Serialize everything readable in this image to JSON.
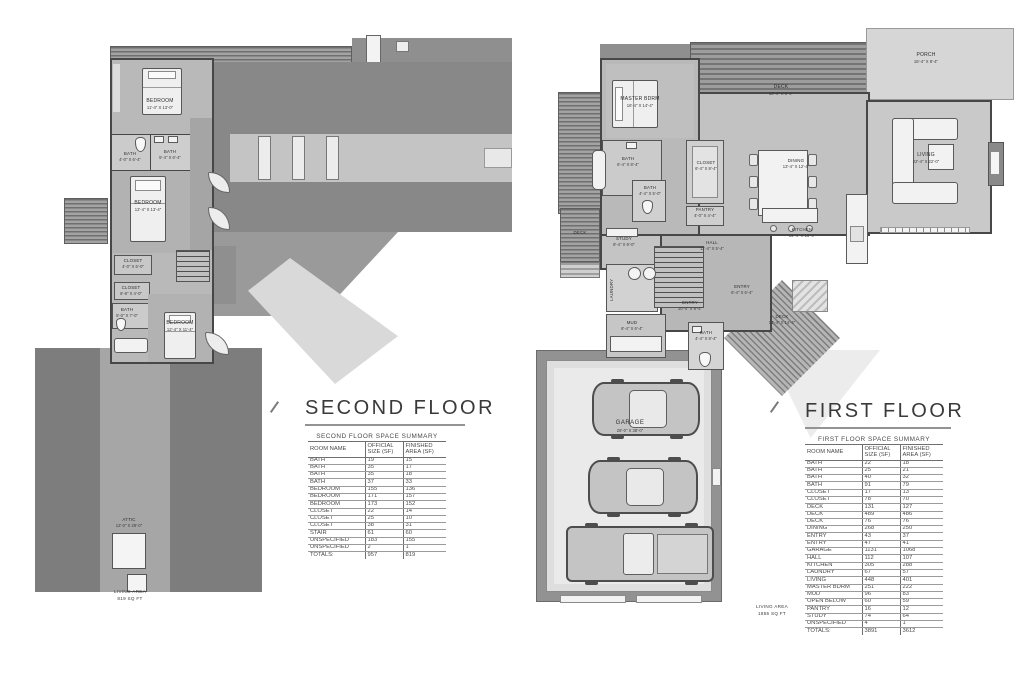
{
  "palette": {
    "paper": "#ffffff",
    "roof_dark": "#6f6f6f",
    "roof_mid": "#888888",
    "roof_light": "#c6c6c6",
    "building_fill": "#b9b9b9",
    "wall_line": "#474747",
    "fixture": "#f2f2f2",
    "table_line": "#9b9b9b",
    "text": "#3a3a3a"
  },
  "second_floor": {
    "title": "SECOND FLOOR",
    "summary": {
      "caption": "SECOND FLOOR SPACE SUMMARY",
      "columns": [
        "ROOM NAME",
        "OFFICIAL SIZE (SF)",
        "FINISHED AREA (SF)"
      ],
      "rows": [
        [
          "BATH",
          "19",
          "15"
        ],
        [
          "BATH",
          "35",
          "17"
        ],
        [
          "BATH",
          "35",
          "18"
        ],
        [
          "BATH",
          "37",
          "33"
        ],
        [
          "BEDROOM",
          "155",
          "136"
        ],
        [
          "BEDROOM",
          "171",
          "157"
        ],
        [
          "BEDROOM",
          "173",
          "152"
        ],
        [
          "CLOSET",
          "22",
          "14"
        ],
        [
          "CLOSET",
          "25",
          "10"
        ],
        [
          "CLOSET",
          "38",
          "31"
        ],
        [
          "STAIR",
          "61",
          "60"
        ],
        [
          "UNSPECIFIED",
          "183",
          "155"
        ],
        [
          "UNSPECIFIED",
          "2",
          "1"
        ]
      ],
      "totals": [
        "TOTALS:",
        "957",
        "819"
      ]
    },
    "rooms": {
      "bedroom1": {
        "name": "BEDROOM",
        "dims": "11'-4\" X 13'-0\""
      },
      "bath1": {
        "name": "BATH",
        "dims": "4'-0\" X 6'-4\""
      },
      "bath2": {
        "name": "BATH",
        "dims": "5'-4\" X 6'-4\""
      },
      "bedroom2": {
        "name": "BEDROOM",
        "dims": "12'-4\" X 13'-4\""
      },
      "closet1": {
        "name": "CLOSET",
        "dims": "4'-0\" X 6'-0\""
      },
      "closet2": {
        "name": "CLOSET",
        "dims": "6'-8\" X 4'-0\""
      },
      "bath3": {
        "name": "BATH",
        "dims": "5'-0\" X 7'-0\""
      },
      "bedroom3": {
        "name": "BEDROOM",
        "dims": "12'-4\" X 11'-4\""
      },
      "attic": {
        "name": "ATTIC",
        "dims": "12'-0\" X 28'-0\""
      }
    },
    "area_note": [
      "LIVING AREA",
      "819 SQ FT"
    ]
  },
  "first_floor": {
    "title": "FIRST FLOOR",
    "summary": {
      "caption": "FIRST FLOOR SPACE SUMMARY",
      "columns": [
        "ROOM NAME",
        "OFFICIAL SIZE (SF)",
        "FINISHED AREA (SF)"
      ],
      "rows": [
        [
          "BATH",
          "22",
          "18"
        ],
        [
          "BATH",
          "25",
          "21"
        ],
        [
          "BATH",
          "40",
          "32"
        ],
        [
          "BATH",
          "91",
          "79"
        ],
        [
          "CLOSET",
          "17",
          "13"
        ],
        [
          "CLOSET",
          "78",
          "70"
        ],
        [
          "DECK",
          "131",
          "127"
        ],
        [
          "DECK",
          "489",
          "486"
        ],
        [
          "DECK",
          "76",
          "76"
        ],
        [
          "DINING",
          "268",
          "250"
        ],
        [
          "ENTRY",
          "43",
          "37"
        ],
        [
          "ENTRY",
          "47",
          "41"
        ],
        [
          "GARAGE",
          "1131",
          "1068"
        ],
        [
          "HALL",
          "112",
          "107"
        ],
        [
          "KITCHEN",
          "305",
          "288"
        ],
        [
          "LAUNDRY",
          "67",
          "57"
        ],
        [
          "LIVING",
          "448",
          "401"
        ],
        [
          "MASTER BDRM",
          "251",
          "222"
        ],
        [
          "MUD",
          "96",
          "83"
        ],
        [
          "OPEN BELOW",
          "60",
          "59"
        ],
        [
          "PANTRY",
          "16",
          "12"
        ],
        [
          "STUDY",
          "74",
          "64"
        ],
        [
          "UNSPECIFIED",
          "4",
          "1"
        ]
      ],
      "totals": [
        "TOTALS:",
        "3891",
        "3612"
      ]
    },
    "rooms": {
      "master": {
        "name": "MASTER BDRM",
        "dims": "16'-4\" X 14'-4\""
      },
      "deck_top": {
        "name": "DECK",
        "dims": "18'-4\" X 8'-4\""
      },
      "porch": {
        "name": "PORCH",
        "dims": "16'-4\" X 8'-4\""
      },
      "living": {
        "name": "LIVING",
        "dims": "22'-4\" X 22'-0\""
      },
      "bath1": {
        "name": "BATH",
        "dims": "6'-4\" X 8'-4\""
      },
      "bath2": {
        "name": "BATH",
        "dims": "4'-4\" X 5'-0\""
      },
      "closet": {
        "name": "CLOSET",
        "dims": "6'-4\" X 8'-4\""
      },
      "pantry": {
        "name": "PANTRY",
        "dims": "4'-0\" X 4'-4\""
      },
      "dining": {
        "name": "DINING",
        "dims": "13'-4\" X 12'-4\""
      },
      "kitchen": {
        "name": "KITCHEN",
        "dims": "15'-4\" X 13'-4\""
      },
      "study": {
        "name": "STUDY",
        "dims": "8'-4\" X 9'-0\""
      },
      "hall": {
        "name": "HALL",
        "dims": "11'-4\" X 5'-4\""
      },
      "laundry": {
        "name": "LAUNDRY",
        "dims": "6'-4\" X 11'-0\""
      },
      "entry_main": {
        "name": "ENTRY",
        "dims": "10'-4\" X 6'-4\""
      },
      "entry_side": {
        "name": "ENTRY",
        "dims": "6'-4\" X 6'-4\""
      },
      "mud": {
        "name": "MUD",
        "dims": "8'-4\" X 6'-4\""
      },
      "bath3": {
        "name": "BATH",
        "dims": "4'-4\" X 8'-4\""
      },
      "deck_right": {
        "name": "DECK",
        "dims": "14'-4\" X 14'-4\""
      },
      "deck_left": {
        "name": "DECK",
        "dims": ""
      },
      "garage": {
        "name": "GARAGE",
        "dims": "28'-0\" X 38'-0\""
      }
    },
    "area_note": [
      "LIVING AREA",
      "1855 SQ FT"
    ]
  }
}
